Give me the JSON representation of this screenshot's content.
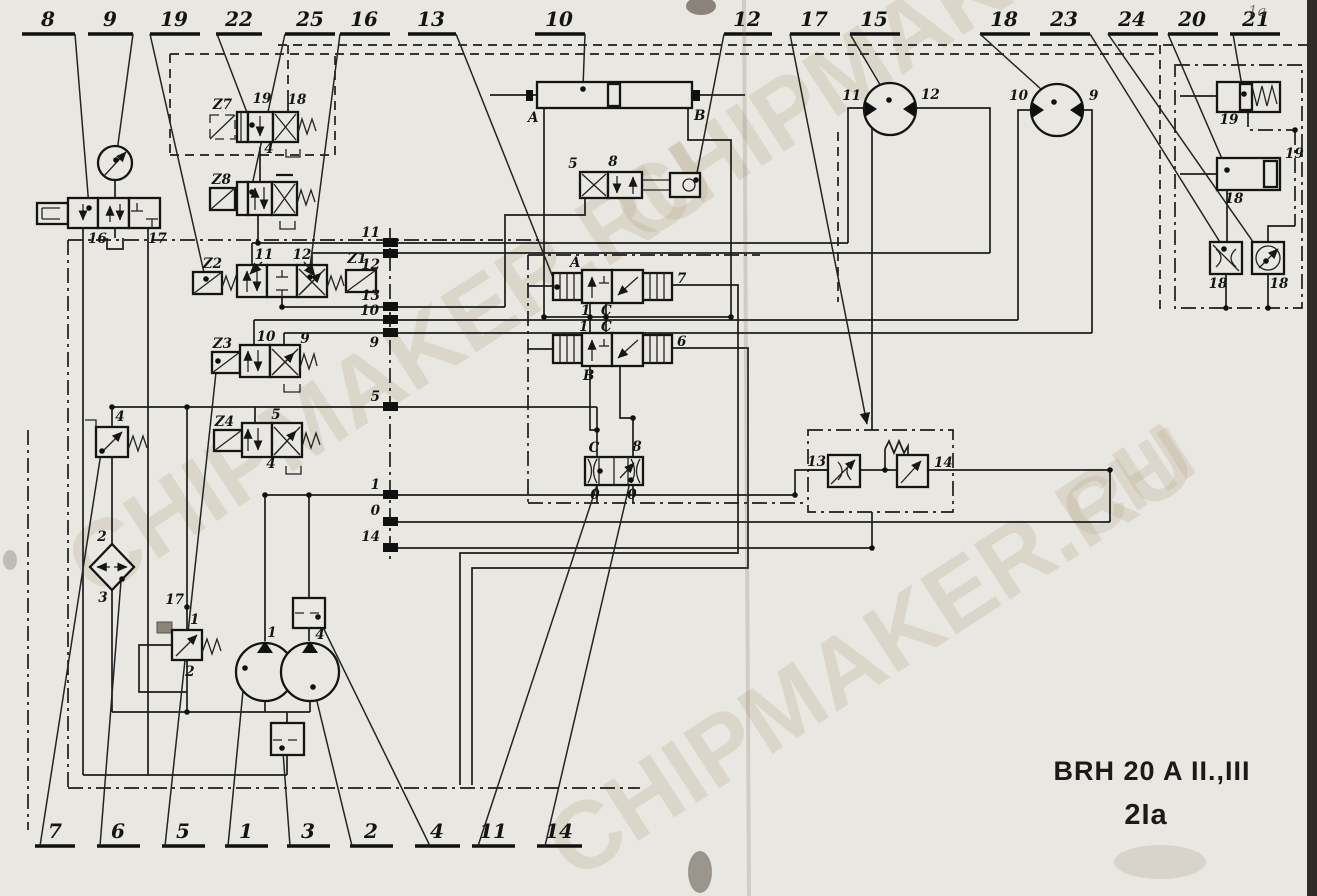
{
  "title_block": {
    "model": "BRH 20 A II.,III",
    "sheet": "2Ia"
  },
  "watermark": "CHIPMAKER.RU",
  "watermark_short": "CHI",
  "handwriting": "1a",
  "top_callouts": [
    "8",
    "9",
    "19",
    "22",
    "25",
    "16",
    "13",
    "10",
    "12",
    "17",
    "15",
    "18",
    "23",
    "24",
    "20",
    "21"
  ],
  "bottom_callouts": [
    "7",
    "6",
    "5",
    "1",
    "3",
    "2",
    "4",
    "11",
    "14"
  ],
  "port_markers": [
    "11",
    "12",
    "13",
    "10",
    "9",
    "5",
    "1",
    "0",
    "14"
  ],
  "components": {
    "manual_valve": {
      "port_left": "16",
      "port_right": "17"
    },
    "z7": {
      "id": "Z7",
      "top_left": "19",
      "top_right": "18",
      "bottom": "4"
    },
    "z8": {
      "id": "Z8"
    },
    "z2_z1": {
      "sol_left": "Z2",
      "sol_right": "Z1",
      "pos_left": "11",
      "pos_right": "12"
    },
    "z3": {
      "id": "Z3",
      "pos_left": "10",
      "pos_right": "9"
    },
    "z4": {
      "id": "Z4",
      "pos_top": "5",
      "pos_bottom": "4"
    },
    "relief_valve_left": {
      "id": "4"
    },
    "filter": {
      "top": "2",
      "bottom": "3"
    },
    "pump_relief": {
      "top": "17",
      "port": "1",
      "bottom": "2"
    },
    "pump_left": {
      "id": "1"
    },
    "pump_right": {
      "id": "4"
    },
    "cylinder": {
      "port_a": "A",
      "port_b": "B"
    },
    "roller_valve": {
      "left": "5",
      "right": "8"
    },
    "pilot_valve_a": {
      "id": "A",
      "right": "7",
      "port_1": "1",
      "port_c": "C"
    },
    "pilot_valve_b": {
      "id": "B",
      "right": "6",
      "port_1": "1",
      "port_c": "C"
    },
    "shuttle_valve": {
      "top_left": "C",
      "top_right": "8",
      "bottom_left": "0",
      "bottom_right": "0"
    },
    "flow_control": {
      "left": "13",
      "right": "14"
    },
    "motor_left": {
      "port_left": "11",
      "port_right": "12"
    },
    "motor_right": {
      "port_left": "10",
      "port_right": "9"
    },
    "accessory_box": {
      "spring_cylinder": "19",
      "cylinder": "18",
      "throttle": "18",
      "gauge": "18",
      "side": "19"
    }
  }
}
